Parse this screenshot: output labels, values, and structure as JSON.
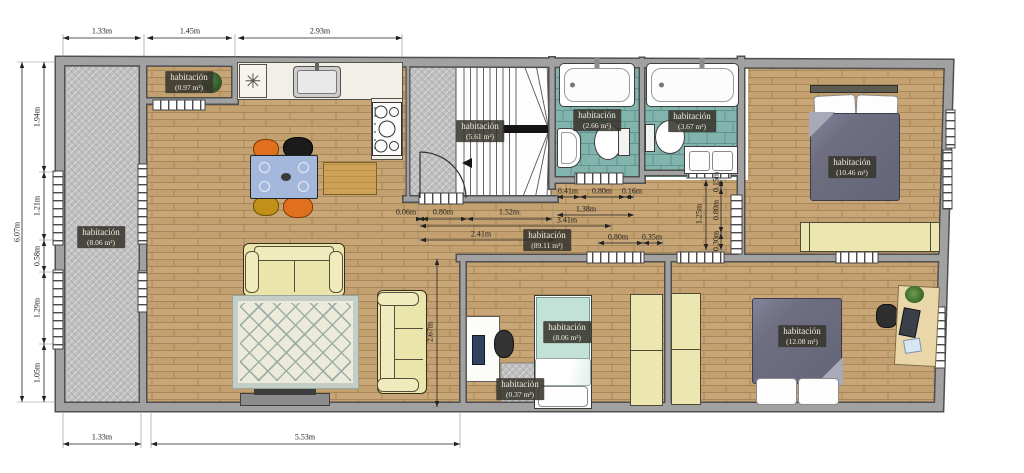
{
  "meta": {
    "drawing_type": "apartment floor plan",
    "language": "es",
    "units": "m"
  },
  "rooms": [
    {
      "id": "storage-top-left",
      "label": "habitación",
      "area": "(0.97 m²)"
    },
    {
      "id": "gallery-left",
      "label": "habitación",
      "area": "(8.06 m²)"
    },
    {
      "id": "staircase",
      "label": "habitación",
      "area": "(5.61 m²)"
    },
    {
      "id": "bathroom-1",
      "label": "habitación",
      "area": "(2.66 m²)"
    },
    {
      "id": "bathroom-2",
      "label": "habitación",
      "area": "(3.67 m²)"
    },
    {
      "id": "bedroom-top-right",
      "label": "habitación",
      "area": "(10.46 m²)"
    },
    {
      "id": "living-kitchen-hall",
      "label": "habitación",
      "area": "(89.11 m²)"
    },
    {
      "id": "bedroom-bottom-middle",
      "label": "habitación",
      "area": "(8.06 m²)"
    },
    {
      "id": "closet-nook",
      "label": "habitación",
      "area": "(0.37 m²)"
    },
    {
      "id": "bedroom-bottom-right",
      "label": "habitación",
      "area": "(12.08 m²)"
    }
  ],
  "dimensions": {
    "top": [
      "1.33m",
      "1.45m",
      "2.93m"
    ],
    "left_overall": "6.07m",
    "left": [
      "1.94m",
      "1.21m",
      "0.58m",
      "1.29m",
      "1.05m"
    ],
    "bottom": [
      "1.33m",
      "5.53m"
    ],
    "corridor_h": [
      "0.06m",
      "0.80m",
      "1.52m",
      "1.38m",
      "3.41m",
      "2.41m"
    ],
    "bath_h": [
      "0.41m",
      "0.80m",
      "0.16m"
    ],
    "right_h": [
      "0.80m",
      "0.35m"
    ],
    "corridor_v": [
      "1.25m",
      "0.15m",
      "0.80m",
      "0.30m"
    ],
    "living_v": "2.67m"
  },
  "icons": {
    "asterisk": "✳"
  },
  "colors": {
    "wall": "#9e9e9e",
    "wall_outline": "#4f4f4f",
    "wood_floor": "#c8a678",
    "tile_floor": "#82b4ad",
    "hatch_floor": "#bfbfbf",
    "label_bg": "#38362d",
    "label_text": "#f0ecdd",
    "furniture_cream": "#eae5ab",
    "bed_duvet": "#6e6e80",
    "bed_teal": "#c2e2d8",
    "table_blue": "#a3b8da",
    "chair_orange": "#e0701d",
    "chair_black": "#1b1b1b",
    "chair_olive": "#c09018",
    "dim_text": "#1d1d1d"
  }
}
